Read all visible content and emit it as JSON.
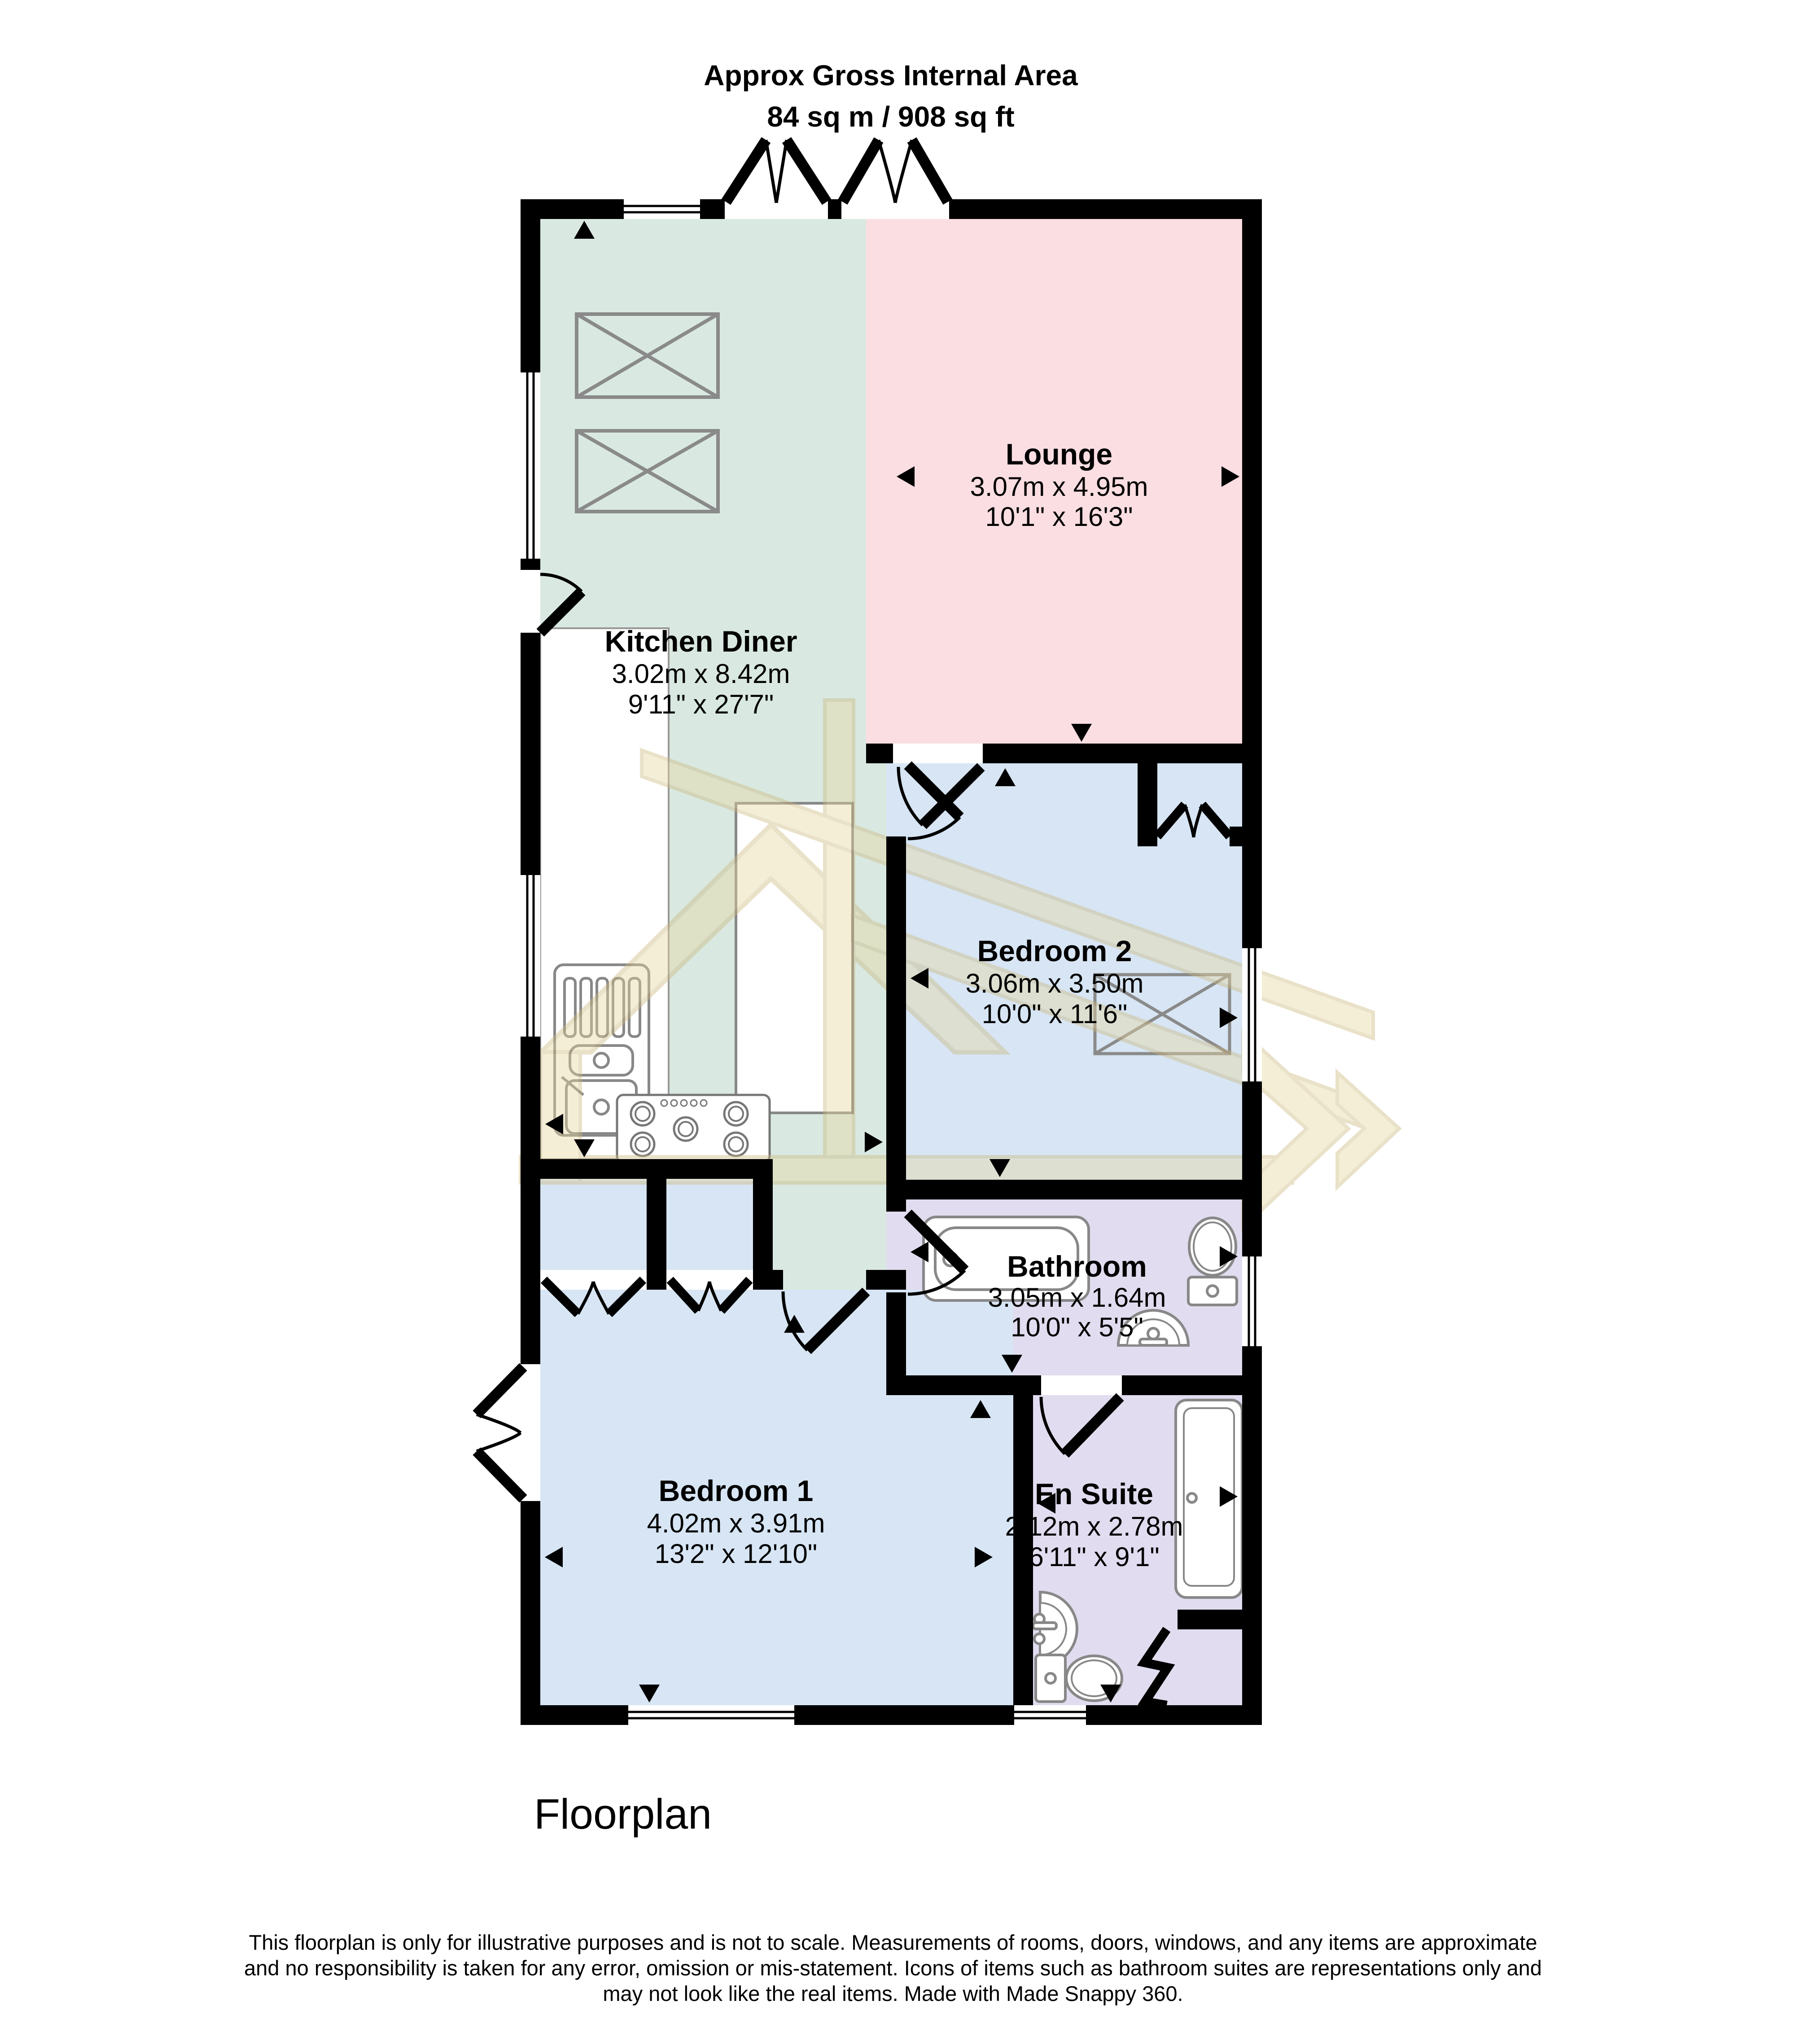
{
  "title": {
    "line1": "Approx Gross Internal Area",
    "line2": "84 sq m / 908 sq ft"
  },
  "rooms": [
    {
      "id": "lounge",
      "name": "Lounge",
      "metric": "3.07m x 4.95m",
      "imperial": "10'1\" x 16'3\"",
      "color": "#fbdee2"
    },
    {
      "id": "kitchen-diner",
      "name": "Kitchen Diner",
      "metric": "3.02m x 8.42m",
      "imperial": "9'11\" x 27'7\"",
      "color": "#d9e9e1"
    },
    {
      "id": "bedroom-2",
      "name": "Bedroom 2",
      "metric": "3.06m x 3.50m",
      "imperial": "10'0\" x 11'6\"",
      "color": "#d7e5f4"
    },
    {
      "id": "bathroom",
      "name": "Bathroom",
      "metric": "3.05m x 1.64m",
      "imperial": "10'0\" x 5'5\"",
      "color": "#e1dcef"
    },
    {
      "id": "bedroom-1",
      "name": "Bedroom 1",
      "metric": "4.02m x 3.91m",
      "imperial": "13'2\" x 12'10\"",
      "color": "#d7e5f4"
    },
    {
      "id": "en-suite",
      "name": "En Suite",
      "metric": "2.12m x 2.78m",
      "imperial": "6'11\" x 9'1\"",
      "color": "#e1dcef"
    }
  ],
  "footer": {
    "plan_label": "Floorplan"
  },
  "disclaimer": {
    "line1": "This floorplan is only for illustrative purposes and is not to scale. Measurements of rooms, doors, windows, and any items are approximate",
    "line2": "and no responsibility is taken for any error, omission or mis-statement. Icons of items such as bathroom suites are representations only and",
    "line3": "may not look like the real items. Made with Made Snappy 360."
  },
  "colors": {
    "wall": "#000000",
    "lounge": "#fbdee2",
    "kitchen": "#d9e9e1",
    "bedroom": "#d7e5f4",
    "bathroom": "#e1dcef",
    "fixture_stroke": "#888888",
    "watermark": "#e7d7a2"
  },
  "watermark": {
    "label": "made-snappy-360-watermark"
  }
}
